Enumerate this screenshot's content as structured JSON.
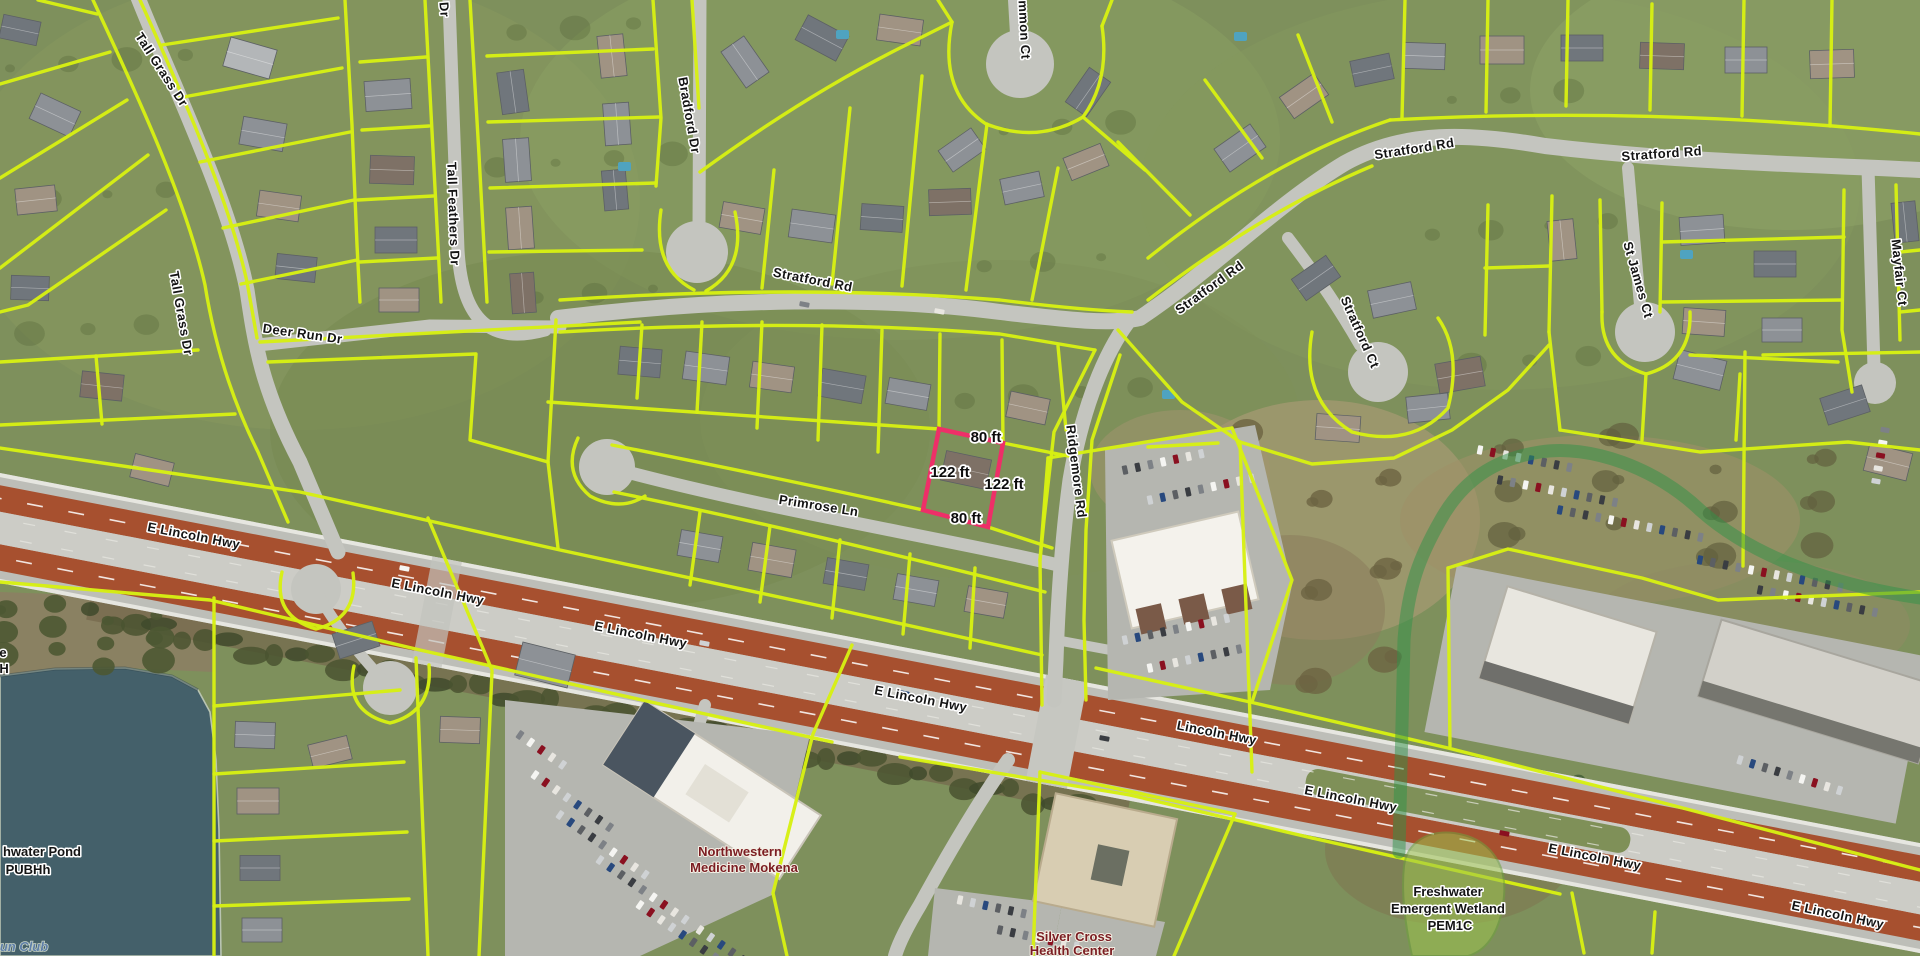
{
  "map": {
    "type": "aerial-parcel-map",
    "street_labels": [
      {
        "t": "Tall Grass Dr",
        "x": 158,
        "y": 72,
        "r": 57
      },
      {
        "t": "Tall Grass Dr",
        "x": 177,
        "y": 314,
        "r": 80
      },
      {
        "t": "Deer Run Dr",
        "x": 302,
        "y": 338,
        "r": 8
      },
      {
        "t": "Tall Feathers Dr",
        "x": 449,
        "y": 214,
        "r": 88
      },
      {
        "t": "Dr",
        "x": 440,
        "y": 10,
        "r": 85
      },
      {
        "t": "Bradford Dr",
        "x": 685,
        "y": 116,
        "r": 80
      },
      {
        "t": "mmon Ct",
        "x": 1020,
        "y": 30,
        "r": 87
      },
      {
        "t": "Stratford Rd",
        "x": 812,
        "y": 284,
        "r": 11
      },
      {
        "t": "Stratford Rd",
        "x": 1212,
        "y": 291,
        "r": -36
      },
      {
        "t": "Stratford Rd",
        "x": 1415,
        "y": 153,
        "r": -9
      },
      {
        "t": "Stratford Rd",
        "x": 1662,
        "y": 158,
        "r": -4
      },
      {
        "t": "Stratford Ct",
        "x": 1356,
        "y": 334,
        "r": 66
      },
      {
        "t": "St James Ct",
        "x": 1634,
        "y": 281,
        "r": 74
      },
      {
        "t": "Mayfair Ct",
        "x": 1895,
        "y": 273,
        "r": 84
      },
      {
        "t": "Primrose Ln",
        "x": 818,
        "y": 510,
        "r": 9
      },
      {
        "t": "Ridgemore Rd",
        "x": 1072,
        "y": 472,
        "r": 83
      },
      {
        "t": "E Lincoln Hwy",
        "x": 193,
        "y": 540,
        "r": 11
      },
      {
        "t": "E Lincoln Hwy",
        "x": 437,
        "y": 596,
        "r": 11
      },
      {
        "t": "E Lincoln Hwy",
        "x": 640,
        "y": 639,
        "r": 11
      },
      {
        "t": "E Lincoln Hwy",
        "x": 920,
        "y": 703,
        "r": 11
      },
      {
        "t": "Lincoln Hwy",
        "x": 1216,
        "y": 737,
        "r": 11
      },
      {
        "t": "E Lincoln Hwy",
        "x": 1350,
        "y": 803,
        "r": 11
      },
      {
        "t": "E Lincoln Hwy",
        "x": 1594,
        "y": 861,
        "r": 11
      },
      {
        "t": "E Lincoln Hwy",
        "x": 1837,
        "y": 919,
        "r": 12
      }
    ],
    "area_labels": [
      {
        "t": "hwater Pond",
        "x": 42,
        "y": 856,
        "cls": "lbl-area"
      },
      {
        "t": "PUBHh",
        "x": 28,
        "y": 874,
        "cls": "lbl-area"
      },
      {
        "t": "e",
        "x": 3,
        "y": 657,
        "cls": "lbl-area"
      },
      {
        "t": "H",
        "x": 4,
        "y": 673,
        "cls": "lbl-area"
      },
      {
        "t": "Freshwater",
        "x": 1448,
        "y": 896,
        "cls": "lbl-area"
      },
      {
        "t": "Emergent Wetland",
        "x": 1448,
        "y": 913,
        "cls": "lbl-area"
      },
      {
        "t": "PEM1C",
        "x": 1450,
        "y": 930,
        "cls": "lbl-area"
      },
      {
        "t": "Northwestern",
        "x": 740,
        "y": 856,
        "cls": "lbl-poi"
      },
      {
        "t": "Medicine Mokena",
        "x": 744,
        "y": 872,
        "cls": "lbl-poi"
      },
      {
        "t": "Silver Cross",
        "x": 1074,
        "y": 941,
        "cls": "lbl-poi"
      },
      {
        "t": "Health Center",
        "x": 1072,
        "y": 955,
        "cls": "lbl-poi"
      },
      {
        "t": "un Club",
        "x": 24,
        "y": 951,
        "cls": "lbl-club"
      }
    ],
    "dimension_labels": [
      {
        "t": "80 ft",
        "x": 986,
        "y": 442
      },
      {
        "t": "122 ft",
        "x": 950,
        "y": 477
      },
      {
        "t": "122 ft",
        "x": 1004,
        "y": 489
      },
      {
        "t": "80 ft",
        "x": 966,
        "y": 523
      }
    ],
    "subject_parcel": {
      "points": "939,429 1003,443 988,527 923,510",
      "frontage": "80 ft",
      "depth": "122 ft"
    },
    "colors": {
      "parcel_line": "#d7f013",
      "subject_parcel": "#ee2f68",
      "wetland_line": "#2f9148",
      "wetland_fill": "#9cc34f",
      "water": "#44606a",
      "street_text": "#141414",
      "poi_text": "#7b1d22",
      "club_text": "#5f7fa8"
    }
  }
}
